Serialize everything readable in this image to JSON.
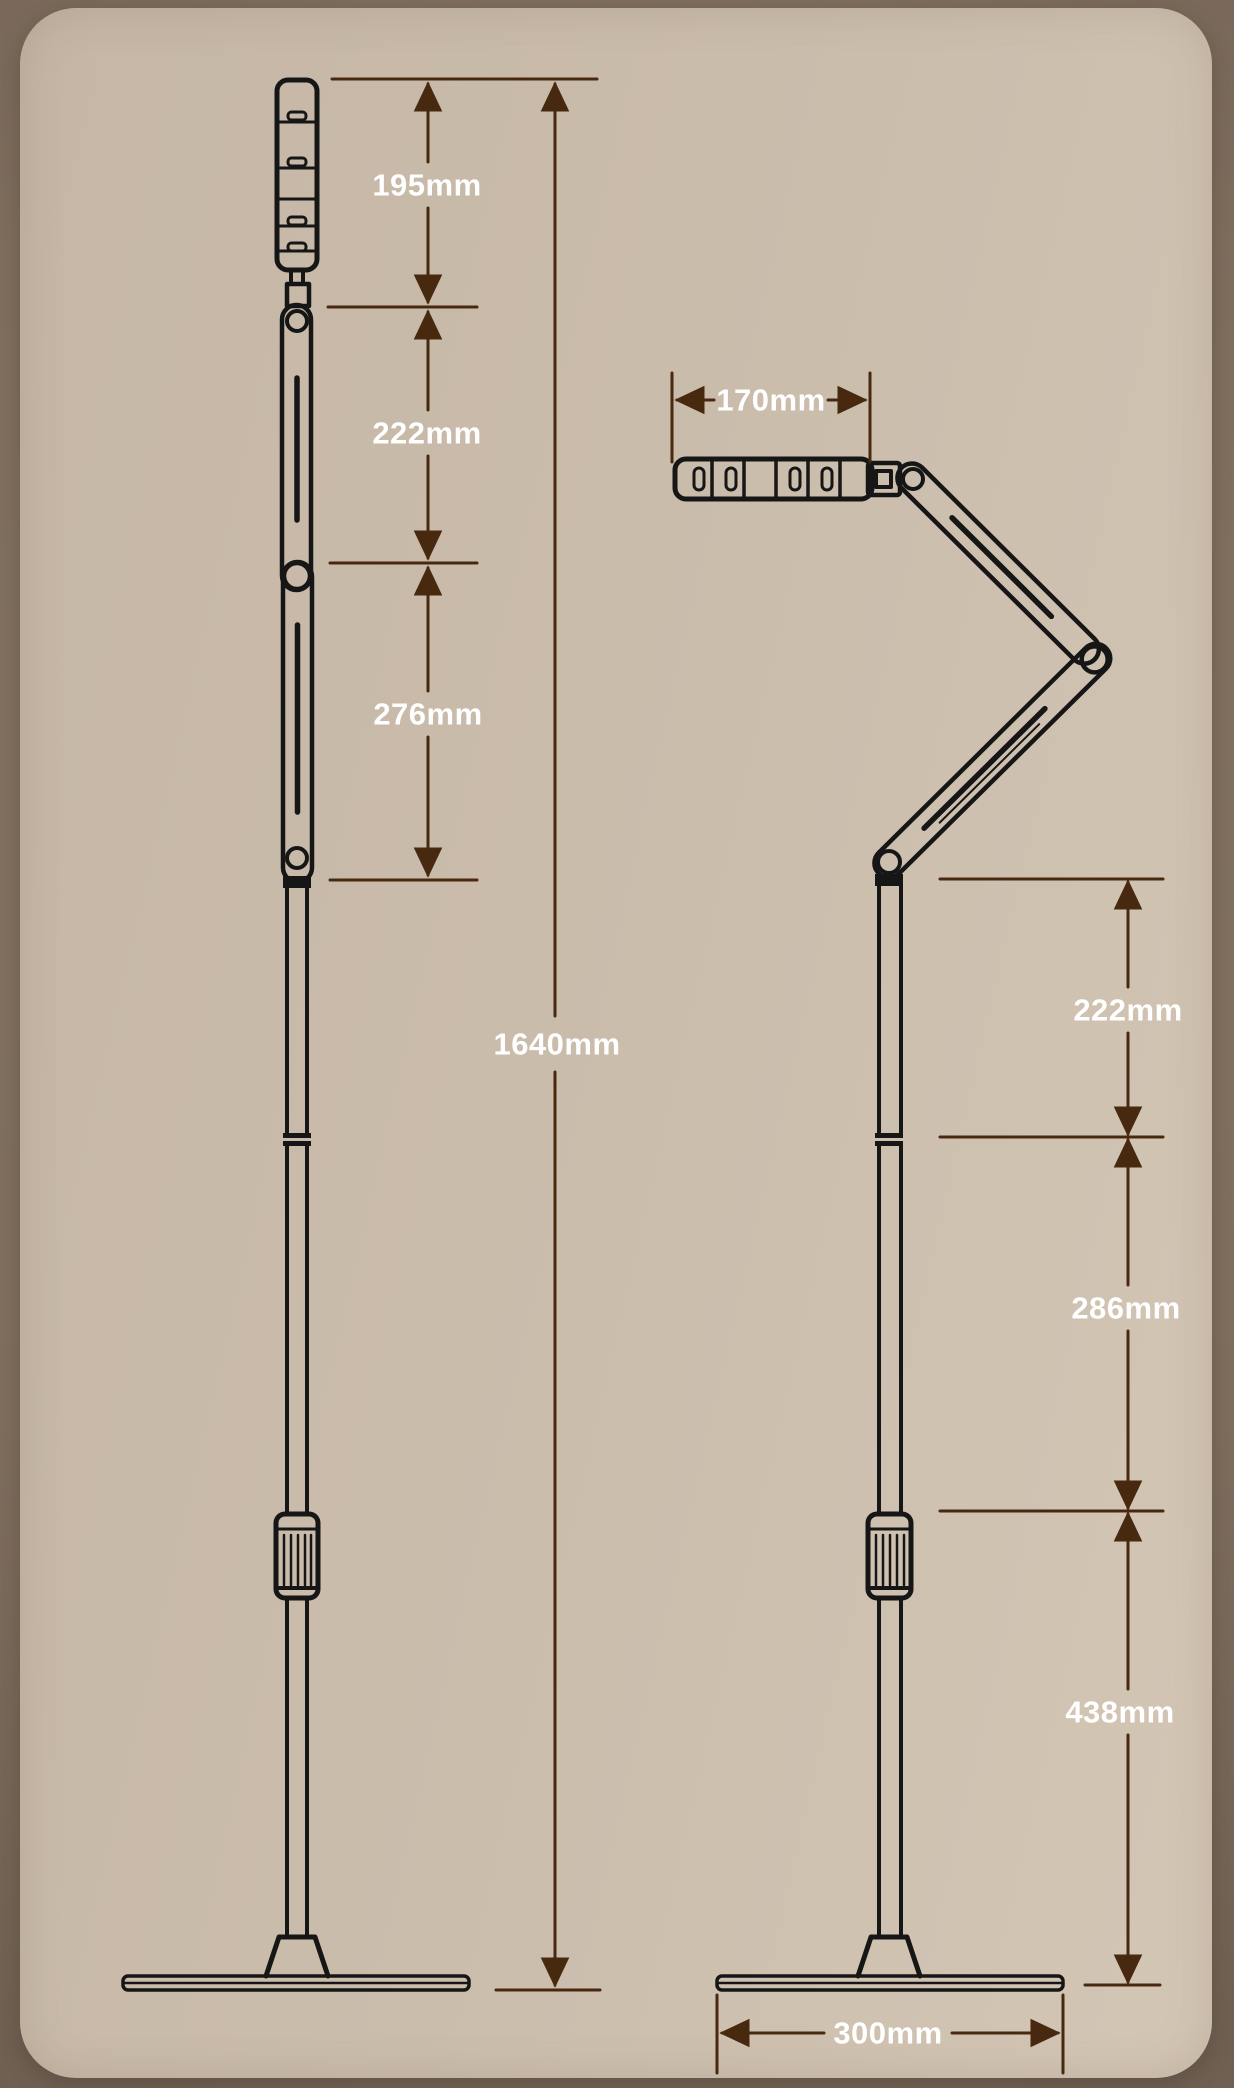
{
  "colors": {
    "outer_background": "#7f6e5e",
    "card_background": "#cbbdac",
    "line_art": "#161616",
    "dimension_accent": "#47290f",
    "label_text": "#ffffff"
  },
  "diagram": {
    "type": "product-dimension-diagram",
    "product": "folding-floor-lamp",
    "views": [
      {
        "name": "front-view-extended",
        "dimensions": [
          {
            "part": "lamp-head-length",
            "label": "195mm"
          },
          {
            "part": "upper-arm-length",
            "label": "222mm"
          },
          {
            "part": "lower-arm-length",
            "label": "276mm"
          },
          {
            "part": "total-height",
            "label": "1640mm"
          }
        ]
      },
      {
        "name": "side-view-folded",
        "dimensions": [
          {
            "part": "head-width",
            "label": "170mm"
          },
          {
            "part": "upper-pole-section",
            "label": "222mm"
          },
          {
            "part": "middle-pole-section",
            "label": "286mm"
          },
          {
            "part": "lower-pole-section",
            "label": "438mm"
          },
          {
            "part": "base-width",
            "label": "300mm"
          }
        ]
      }
    ]
  }
}
